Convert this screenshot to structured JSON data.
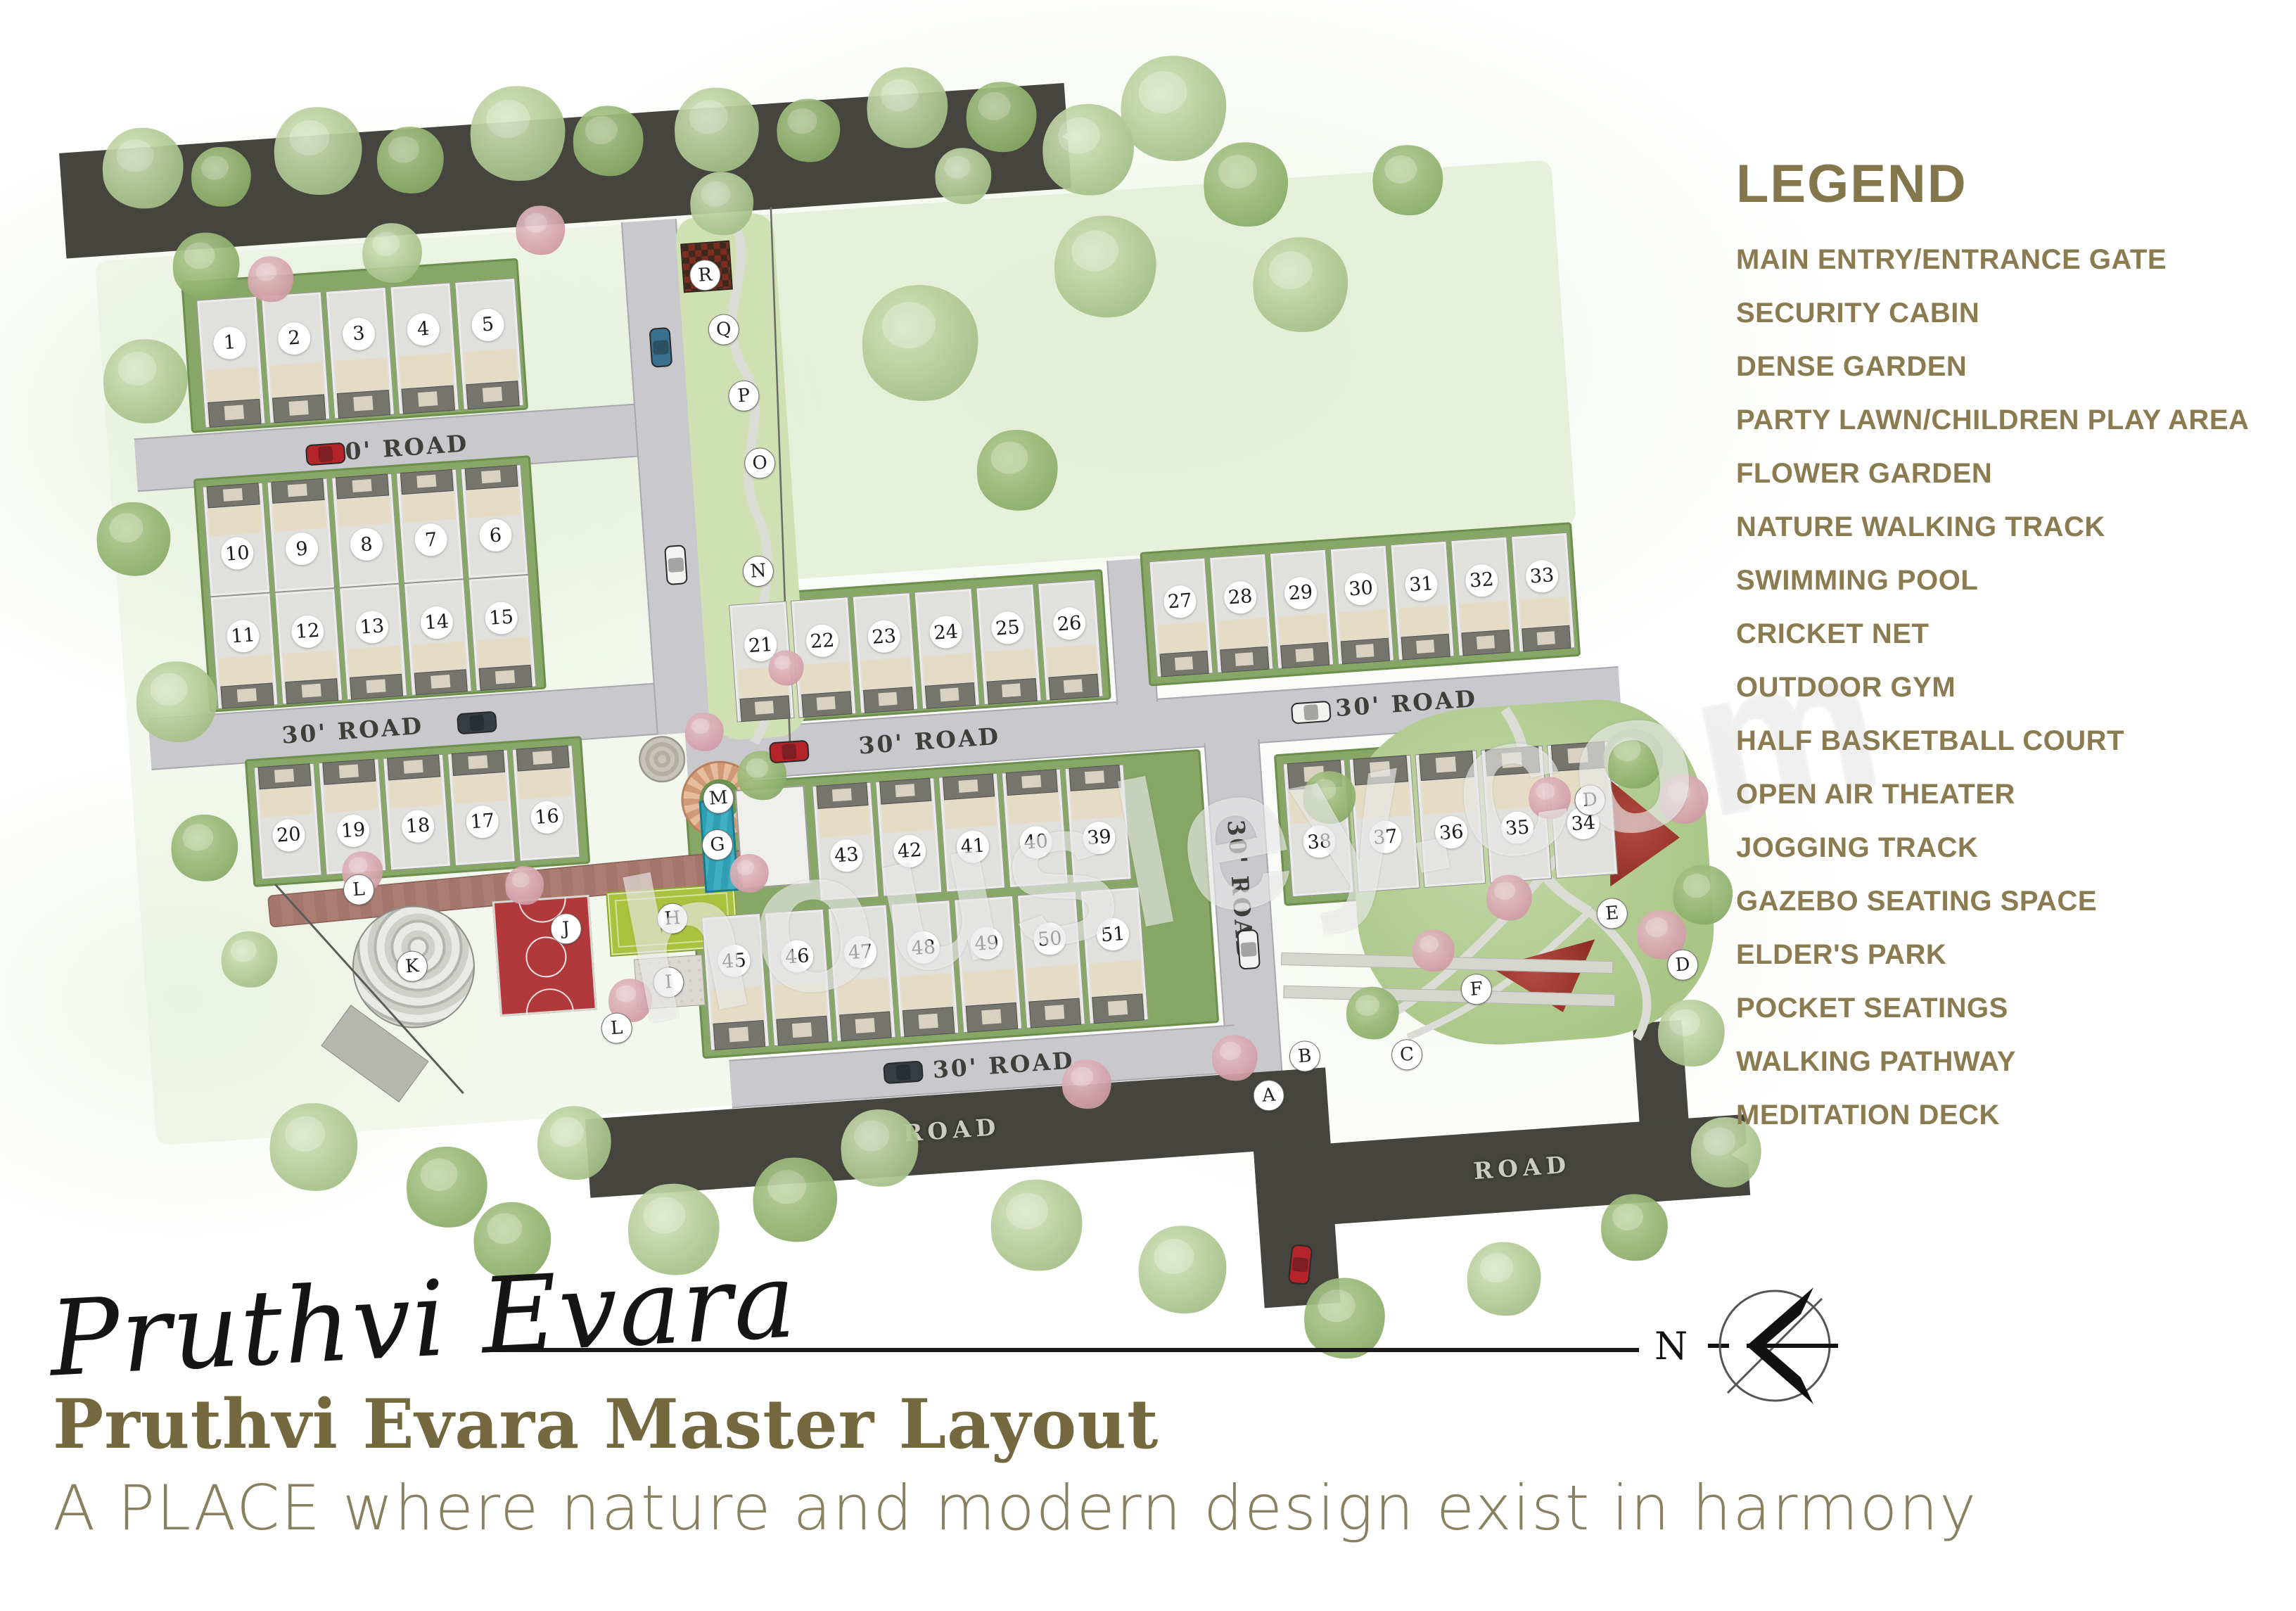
{
  "legend": {
    "title": "LEGEND",
    "items": [
      "MAIN ENTRY/ENTRANCE GATE",
      "SECURITY CABIN",
      "DENSE GARDEN",
      "PARTY LAWN/CHILDREN PLAY AREA",
      "FLOWER GARDEN",
      "NATURE WALKING TRACK",
      "SWIMMING POOL",
      "CRICKET NET",
      "OUTDOOR GYM",
      "HALF BASKETBALL COURT",
      "OPEN AIR THEATER",
      "JOGGING TRACK",
      "GAZEBO SEATING SPACE",
      "ELDER'S PARK",
      "POCKET SEATINGS",
      "WALKING PATHWAY",
      "MEDITATION DECK"
    ]
  },
  "map": {
    "road_label_30": "30' ROAD",
    "road_label": "ROAD",
    "plot_numbers": [
      "1",
      "2",
      "3",
      "4",
      "5",
      "6",
      "7",
      "8",
      "9",
      "10",
      "11",
      "12",
      "13",
      "14",
      "15",
      "16",
      "17",
      "18",
      "19",
      "20",
      "21",
      "22",
      "23",
      "24",
      "25",
      "26",
      "27",
      "28",
      "29",
      "30",
      "31",
      "32",
      "33",
      "34",
      "35",
      "36",
      "37",
      "38",
      "39",
      "40",
      "41",
      "42",
      "43",
      "44",
      "45",
      "46",
      "47",
      "48",
      "49",
      "50",
      "51"
    ],
    "amenity_letters": [
      "A",
      "B",
      "C",
      "D",
      "E",
      "F",
      "G",
      "H",
      "I",
      "J",
      "K",
      "L",
      "M",
      "N",
      "O",
      "P",
      "Q",
      "R"
    ]
  },
  "footer": {
    "signature": "Pruthvi Evara",
    "compass_label": "N",
    "title": "Pruthvi Evara Master Layout",
    "subtitle": "A PLACE where nature and modern design exist in harmony"
  },
  "watermark": "housley.com",
  "colors": {
    "legend_text": "#8a7c50",
    "title_text": "#74683f",
    "subtitle_text": "#8a8060",
    "court_red": "#b2393b",
    "lawn_green": "#aac23e",
    "pool_teal": "#2f9fb3",
    "jogging_brown": "#a3756b",
    "dark_road": "#45443e",
    "gray_road": "#c9c9cd"
  }
}
